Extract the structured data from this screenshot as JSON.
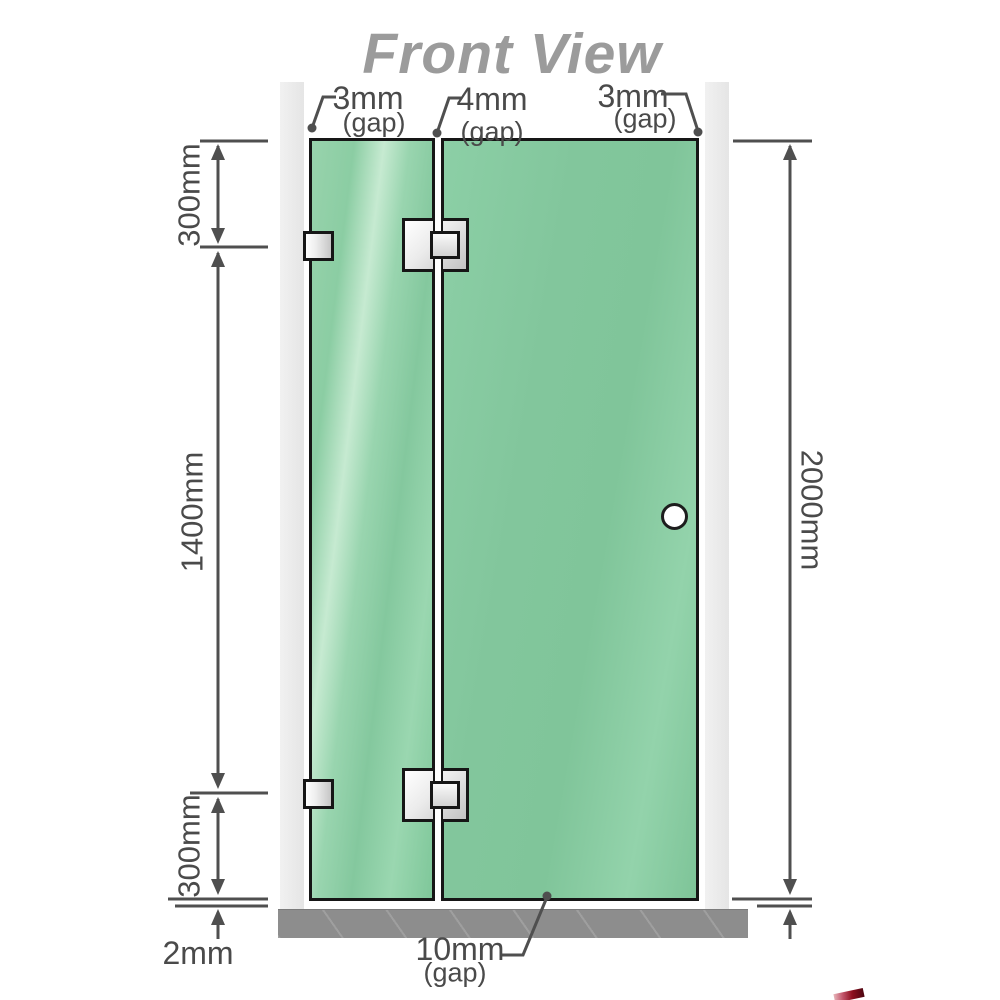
{
  "title": "Front View",
  "gap_labels": {
    "left": {
      "value": "3mm",
      "qualifier": "(gap)"
    },
    "middle": {
      "value": "4mm",
      "qualifier": "(gap)"
    },
    "right": {
      "value": "3mm",
      "qualifier": "(gap)"
    },
    "bottom": {
      "value": "10mm",
      "qualifier": "(gap)"
    }
  },
  "dimensions": {
    "left_top": "300mm",
    "left_middle": "1400mm",
    "left_bottom": "300mm",
    "bottom_left": "2mm",
    "right_full": "2000mm"
  },
  "colors": {
    "line": "#4f4f4f",
    "label": "#4a4a4a",
    "title": "#9b9b9b",
    "glass_base": "#84c89e",
    "glass_light": "#a9dfbc",
    "wall": "#ebebeb",
    "floor": "#8d8d8d",
    "logo_red": "#8f1020"
  }
}
